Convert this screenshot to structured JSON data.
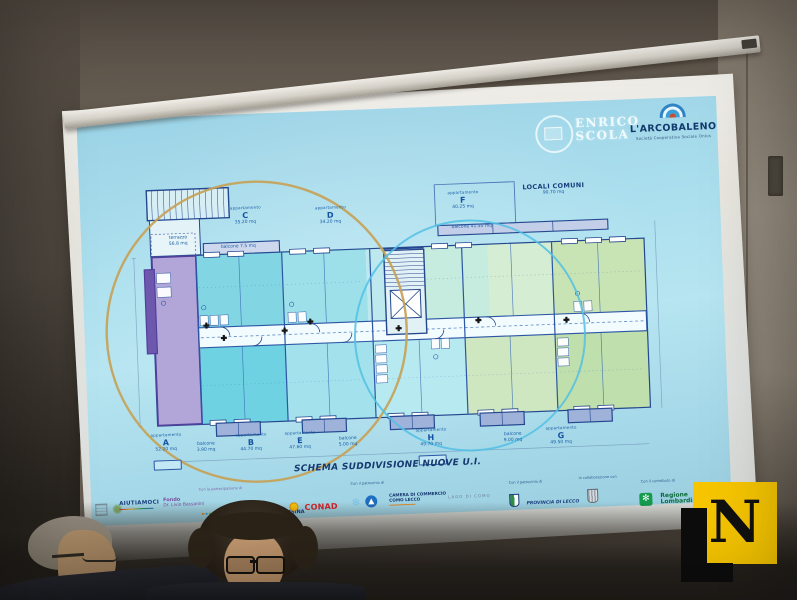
{
  "slide": {
    "school": {
      "line1": "ENRICO",
      "line2": "SCOLA"
    },
    "arcobaleno": {
      "title": "L'ARCOBALENO",
      "subtitle": "Società Cooperativa Sociale Onlus",
      "icon": "rainbow-icon"
    },
    "plan": {
      "title": "SCHEMA SUDDIVISIONE NUOVE U.I.",
      "units": [
        {
          "kind": "appartamento",
          "letter": "C",
          "area": "35.20 mq"
        },
        {
          "kind": "appartamento",
          "letter": "D",
          "area": "34.20 mq"
        },
        {
          "kind": "appartamento",
          "letter": "F",
          "area": "40.25 mq"
        },
        {
          "kind": "appartamento",
          "letter": "A",
          "area": "52.20 mq"
        },
        {
          "kind": "appartamento",
          "letter": "B",
          "area": "44.70 mq"
        },
        {
          "kind": "appartamento",
          "letter": "E",
          "area": "47.60 mq"
        },
        {
          "kind": "appartamento",
          "letter": "H",
          "area": "49.70 mq"
        },
        {
          "kind": "appartamento",
          "letter": "G",
          "area": "49.50 mq"
        }
      ],
      "common": {
        "name": "LOCALI COMUNI",
        "area": "90.70 mq"
      },
      "balconies": [
        {
          "kind": "terrazzo",
          "area": "56.8 mq"
        },
        {
          "kind": "balcone",
          "area": "7.5 mq"
        },
        {
          "kind": "balcone",
          "area": "41.50 mq"
        },
        {
          "kind": "balcone",
          "area": "3.90 mq"
        },
        {
          "kind": "balcone",
          "area": "5.00 mq"
        },
        {
          "kind": "balcone",
          "area": "9.00 mq"
        }
      ]
    },
    "footer": {
      "captions": {
        "partecipazione": "Con la partecipazione di",
        "patrocinio1": "Con il patrocinio di",
        "patrocinio2": "Con il patrocinio di",
        "collaborazione": "in collaborazione con",
        "contributo": "Con il contributo di"
      },
      "sponsors": {
        "aiutiamoci": "AIUTIAMOCI",
        "fondo_line1": "Fondo",
        "fondo_line2": "Dr. Livio Bassanini",
        "acinque": "acinque",
        "bcc": "BCC VALSASSINA",
        "conad": "CONAD",
        "camera_line1": "CAMERA DI COMMERCIO",
        "camera_line2": "COMO LECCO",
        "lago": "LAGO DI COMO",
        "provincia": "PROVINCIA DI LECCO",
        "regione_line1": "Regione",
        "regione_line2": "Lombardia",
        "regione_glyph": "✻",
        "snowflake_glyph": "❄"
      }
    }
  },
  "watermark": {
    "letter": "N"
  },
  "colors": {
    "slide_bg": "#a9dcec",
    "plan_wall": "#24488f",
    "unit_purple": "#b2a6d8",
    "unit_cyan": "#6fd2e2",
    "unit_green": "#cfe7c0",
    "circle_gold": "#c6a257",
    "circle_blue": "#52c0e4",
    "conad_red": "#d2232a",
    "regione_green": "#169b4e",
    "watermark_yellow": "#f7c600"
  }
}
